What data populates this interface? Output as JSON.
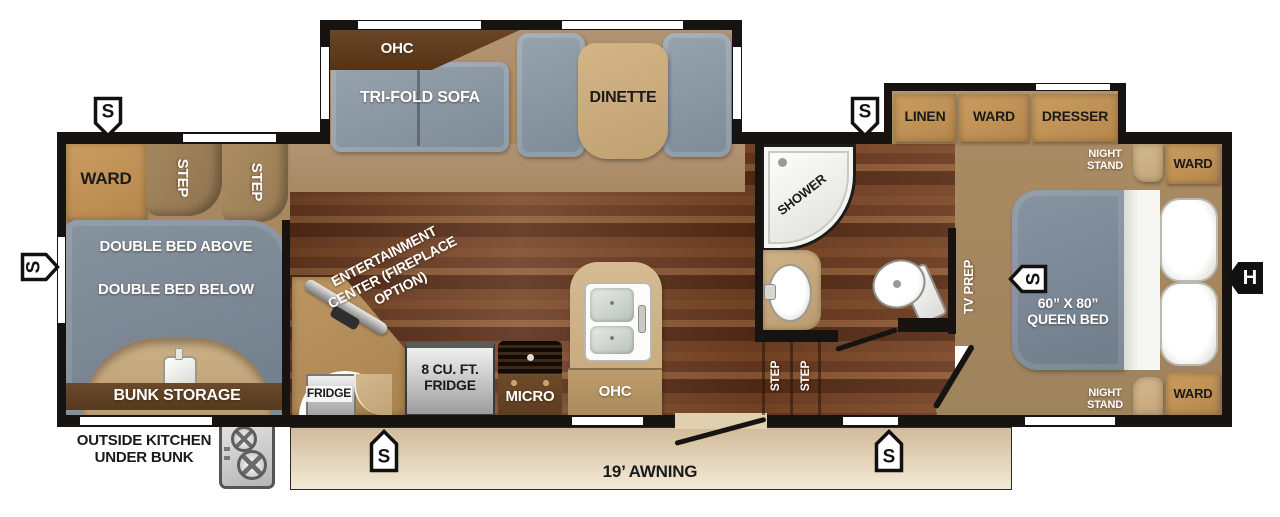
{
  "floorplan": {
    "front_slide": {
      "ohc": "OHC",
      "sofa": "TRI-FOLD SOFA",
      "dinette": "DINETTE"
    },
    "bunk_room": {
      "ward": "WARD",
      "step_upper": "STEP",
      "step_lower": "STEP",
      "bed_above": "DOUBLE BED ABOVE",
      "bed_below": "DOUBLE BED BELOW",
      "bunk_storage": "BUNK STORAGE"
    },
    "outside_kitchen": {
      "line1": "OUTSIDE KITCHEN",
      "line2": "UNDER BUNK"
    },
    "awning": {
      "label": "19’ AWNING"
    },
    "kitchen": {
      "entertainment": "ENTERTAINMENT\nCENTER (FIREPLACE\nOPTION)",
      "outside_fridge": "FRIDGE",
      "fridge": "8 CU. FT.\nFRIDGE",
      "micro": "MICRO",
      "ohc": "OHC"
    },
    "bathroom": {
      "shower": "SHOWER"
    },
    "hall": {
      "step_front": "STEP",
      "step_rear": "STEP",
      "tv_prep": "TV PREP"
    },
    "bedroom_slide": {
      "linen": "LINEN",
      "ward": "WARD",
      "dresser": "DRESSER"
    },
    "bedroom": {
      "night_stand_front": "NIGHT\nSTAND",
      "ward_front": "WARD",
      "bed": "60” X 80”\nQUEEN BED",
      "night_stand_rear": "NIGHT\nSTAND",
      "ward_rear": "WARD"
    },
    "markers": {
      "speaker": "S",
      "hitch": "H"
    },
    "colors": {
      "wall": "#171310",
      "wood_floor": "#6b3a1f",
      "carpet": "#a3865f",
      "cabinet_tan": "#c09357",
      "counter_tan": "#c9ad85",
      "dark_cabinet": "#5e4127",
      "furniture_gray": "#8b98a6",
      "bunk_gray": "#7a8694",
      "awning": "#e6d7ba"
    }
  }
}
